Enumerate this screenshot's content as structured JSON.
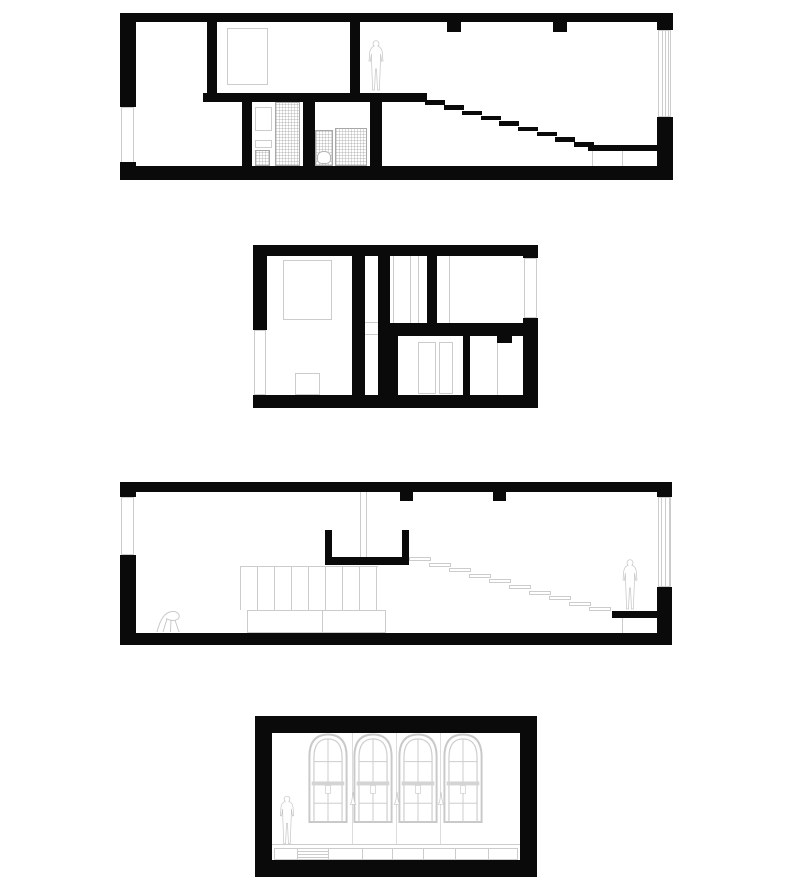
{
  "document": {
    "type": "architectural-drawing-sheet",
    "title": "House sections, floor plan and interior elevation",
    "background": "#ffffff"
  },
  "palette": {
    "wall_black": "#0a0a0a",
    "outline_gray": "#cccccc",
    "hatch_gray": "#828282",
    "figure_gray": "#c4c4c4",
    "background": "#ffffff"
  },
  "drawings": [
    {
      "id": "section-upper",
      "name": "Longitudinal section - upper level: bedroom, bathroom core and stair descending right",
      "stair_treads": 9,
      "ceiling_beams": 2,
      "figures": 1,
      "windows": 2,
      "fixtures": [
        "bed",
        "vanity",
        "toilet",
        "tiled partitions"
      ]
    },
    {
      "id": "floor-plan",
      "name": "Floor plan - bedroom with bed, corridor strip, closet rooms and double doors",
      "rooms": 5,
      "windows": 2,
      "fixtures": [
        "bed",
        "closet partitions",
        "double doors"
      ]
    },
    {
      "id": "section-lower",
      "name": "Longitudinal section - living level: guard profile, open stair to platform, storage wall and counter",
      "stair_treads": 10,
      "ceiling_beams": 2,
      "figures": 1,
      "windows": 2,
      "fixtures": [
        "storage panels",
        "counter",
        "lounge chair",
        "platform"
      ]
    },
    {
      "id": "interior-elevation",
      "name": "Interior elevation - four arched multi-pane windows, pendant lamps and low cabinet run",
      "arched_windows": 4,
      "pendant_lamps": 3,
      "cabinet_sections": 8,
      "figures": 1
    }
  ]
}
